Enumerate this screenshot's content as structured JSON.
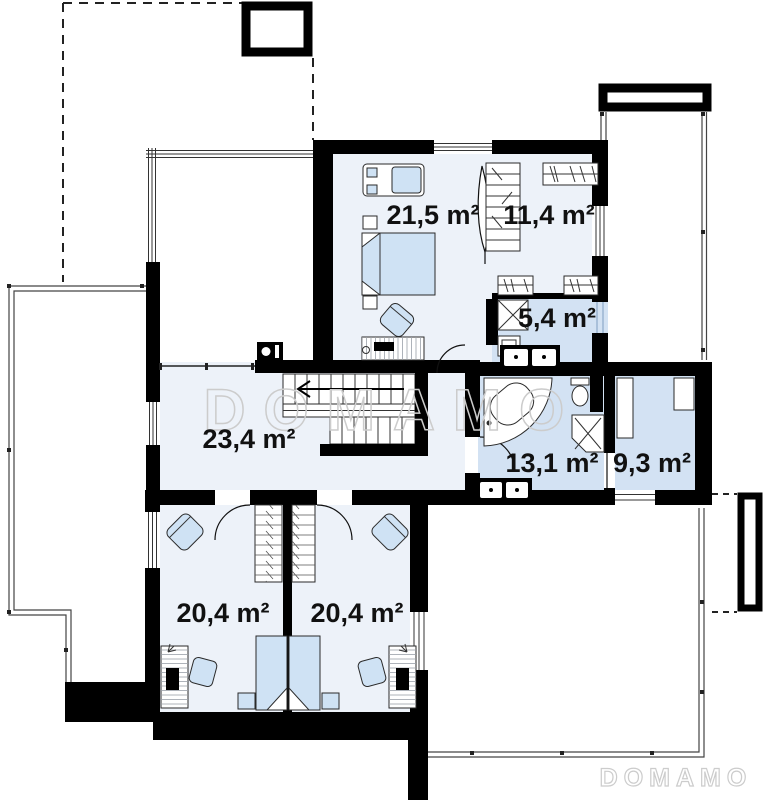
{
  "plan": {
    "watermarks": {
      "center": "DOMAMO",
      "corner": "DOMAMO"
    },
    "room_labels": {
      "bedroom_top": "21,5 m²",
      "wardrobe": "11,4 m²",
      "bath_small": "5,4 m²",
      "hall": "23,4 m²",
      "bath_main": "13,1 m²",
      "closet": "9,3 m²",
      "bedroom_left": "20,4 m²",
      "bedroom_right": "20,4 m²"
    },
    "colors": {
      "wall": "#000000",
      "floor": "#edf2f9",
      "floor_wet": "#d3e2f3",
      "furn": "#cfe2f4",
      "watermark": "#cccccc"
    }
  }
}
